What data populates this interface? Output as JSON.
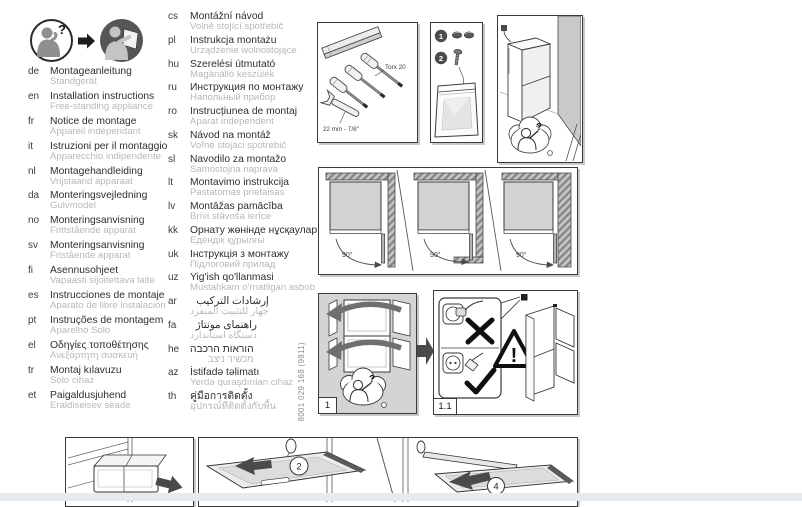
{
  "page": {
    "doc_number": "8001 029 168 (9811)"
  },
  "colors": {
    "ink": "#3a3a3a",
    "subtitle_gray": "#b8b8b8",
    "panel_gray": "#d4d4d4",
    "wall_gray": "#c9c9c9",
    "band_gray": "#e8ebed"
  },
  "header_icons": {
    "question_mark": "?"
  },
  "languages_col1": [
    {
      "code": "de",
      "title": "Montageanleitung",
      "subtitle": "Standgerät"
    },
    {
      "code": "en",
      "title": "Installation instructions",
      "subtitle": "Free-standing appliance"
    },
    {
      "code": "fr",
      "title": "Notice de montage",
      "subtitle": "Appareil indépendant"
    },
    {
      "code": "it",
      "title": "Istruzioni per il montaggio",
      "subtitle": "Apparecchio indipendente"
    },
    {
      "code": "nl",
      "title": "Montagehandleiding",
      "subtitle": "Vrijstaand apparaat"
    },
    {
      "code": "da",
      "title": "Monteringsvejledning",
      "subtitle": "Gulvmodel"
    },
    {
      "code": "no",
      "title": "Monteringsanvisning",
      "subtitle": "Frittstående apparat"
    },
    {
      "code": "sv",
      "title": "Monteringsanvisning",
      "subtitle": "Fristående apparat"
    },
    {
      "code": "fi",
      "title": "Asennusohjeet",
      "subtitle": "Vapaasti sijoitettava laite"
    },
    {
      "code": "es",
      "title": "Instrucciones de montaje",
      "subtitle": "Aparato de libre instalación"
    },
    {
      "code": "pt",
      "title": "Instruções de montagem",
      "subtitle": "Aparelho Solo"
    },
    {
      "code": "el",
      "title": "Οδηγίες τοποθέτησης",
      "subtitle": "Ανεξάρτητη συσκευή"
    },
    {
      "code": "tr",
      "title": "Montaj kılavuzu",
      "subtitle": "Solo cihaz"
    },
    {
      "code": "et",
      "title": "Paigaldusjuhend",
      "subtitle": "Eraldiseisev seade"
    }
  ],
  "languages_col2": [
    {
      "code": "cs",
      "title": "Montážní návod",
      "subtitle": "Volně stojící spotřebič"
    },
    {
      "code": "pl",
      "title": "Instrukcja montażu",
      "subtitle": "Urządzenie wolnostojące"
    },
    {
      "code": "hu",
      "title": "Szerelési útmutató",
      "subtitle": "Magánálló készülék"
    },
    {
      "code": "ru",
      "title": "Инструкция по монтажу",
      "subtitle": "Напольный прибор"
    },
    {
      "code": "ro",
      "title": "Instrucțiunea de montaj",
      "subtitle": "Aparat independent"
    },
    {
      "code": "sk",
      "title": "Návod na montáž",
      "subtitle": "Voľne stojaci spotrebič"
    },
    {
      "code": "sl",
      "title": "Navodilo za montažo",
      "subtitle": "Samostojna naprava"
    },
    {
      "code": "lt",
      "title": "Montavimo instrukcija",
      "subtitle": "Pastatomas prietaisas"
    },
    {
      "code": "lv",
      "title": "Montāžas pamācība",
      "subtitle": "Brīvi stāvoša ierīce"
    },
    {
      "code": "kk",
      "title": "Орнату жөнінде нұсқаулар",
      "subtitle": "Едендік құрылғы"
    },
    {
      "code": "uk",
      "title": "Інструкція з монтажу",
      "subtitle": "Підлоговий прилад"
    },
    {
      "code": "uz",
      "title": "Yig'ish qo'llanmasi",
      "subtitle": "Mustahkam o'rnatilgan asbob"
    },
    {
      "code": "ar",
      "title": "إرشادات التركيب",
      "subtitle": "جهاز للتثبيت المنفرد"
    },
    {
      "code": "fa",
      "title": "راهنمای مونتاژ",
      "subtitle": "دستگاه استاندارد"
    },
    {
      "code": "he",
      "title": "הוראות הרכבה",
      "subtitle": "מכשיר ניצב"
    },
    {
      "code": "az",
      "title": "İstifadə təlimatı",
      "subtitle": "Yerdə quraşdırılan cihaz"
    },
    {
      "code": "th",
      "title": "คู่มือการติดตั้ง",
      "subtitle": "อุปกรณ์ที่ติดตั้งกับพื้น"
    }
  ],
  "diagrams": {
    "tools_box": {
      "torx_label": "Torx 20",
      "wrench_label": "22 mm - 7/8\""
    },
    "parts_box": {
      "part1_number": "1",
      "part2_number": "2"
    },
    "corner_box": {
      "question_mark": "?"
    },
    "door_clearance_box": {
      "angles": [
        "90°",
        "90°",
        "90°"
      ]
    },
    "step1_box": {
      "label": "1",
      "question_mark": "?"
    },
    "step11_box": {
      "label": "1.1",
      "warning_mark": "!"
    },
    "bottom_steps": {
      "step2_number": "2",
      "step4_number": "4"
    }
  }
}
